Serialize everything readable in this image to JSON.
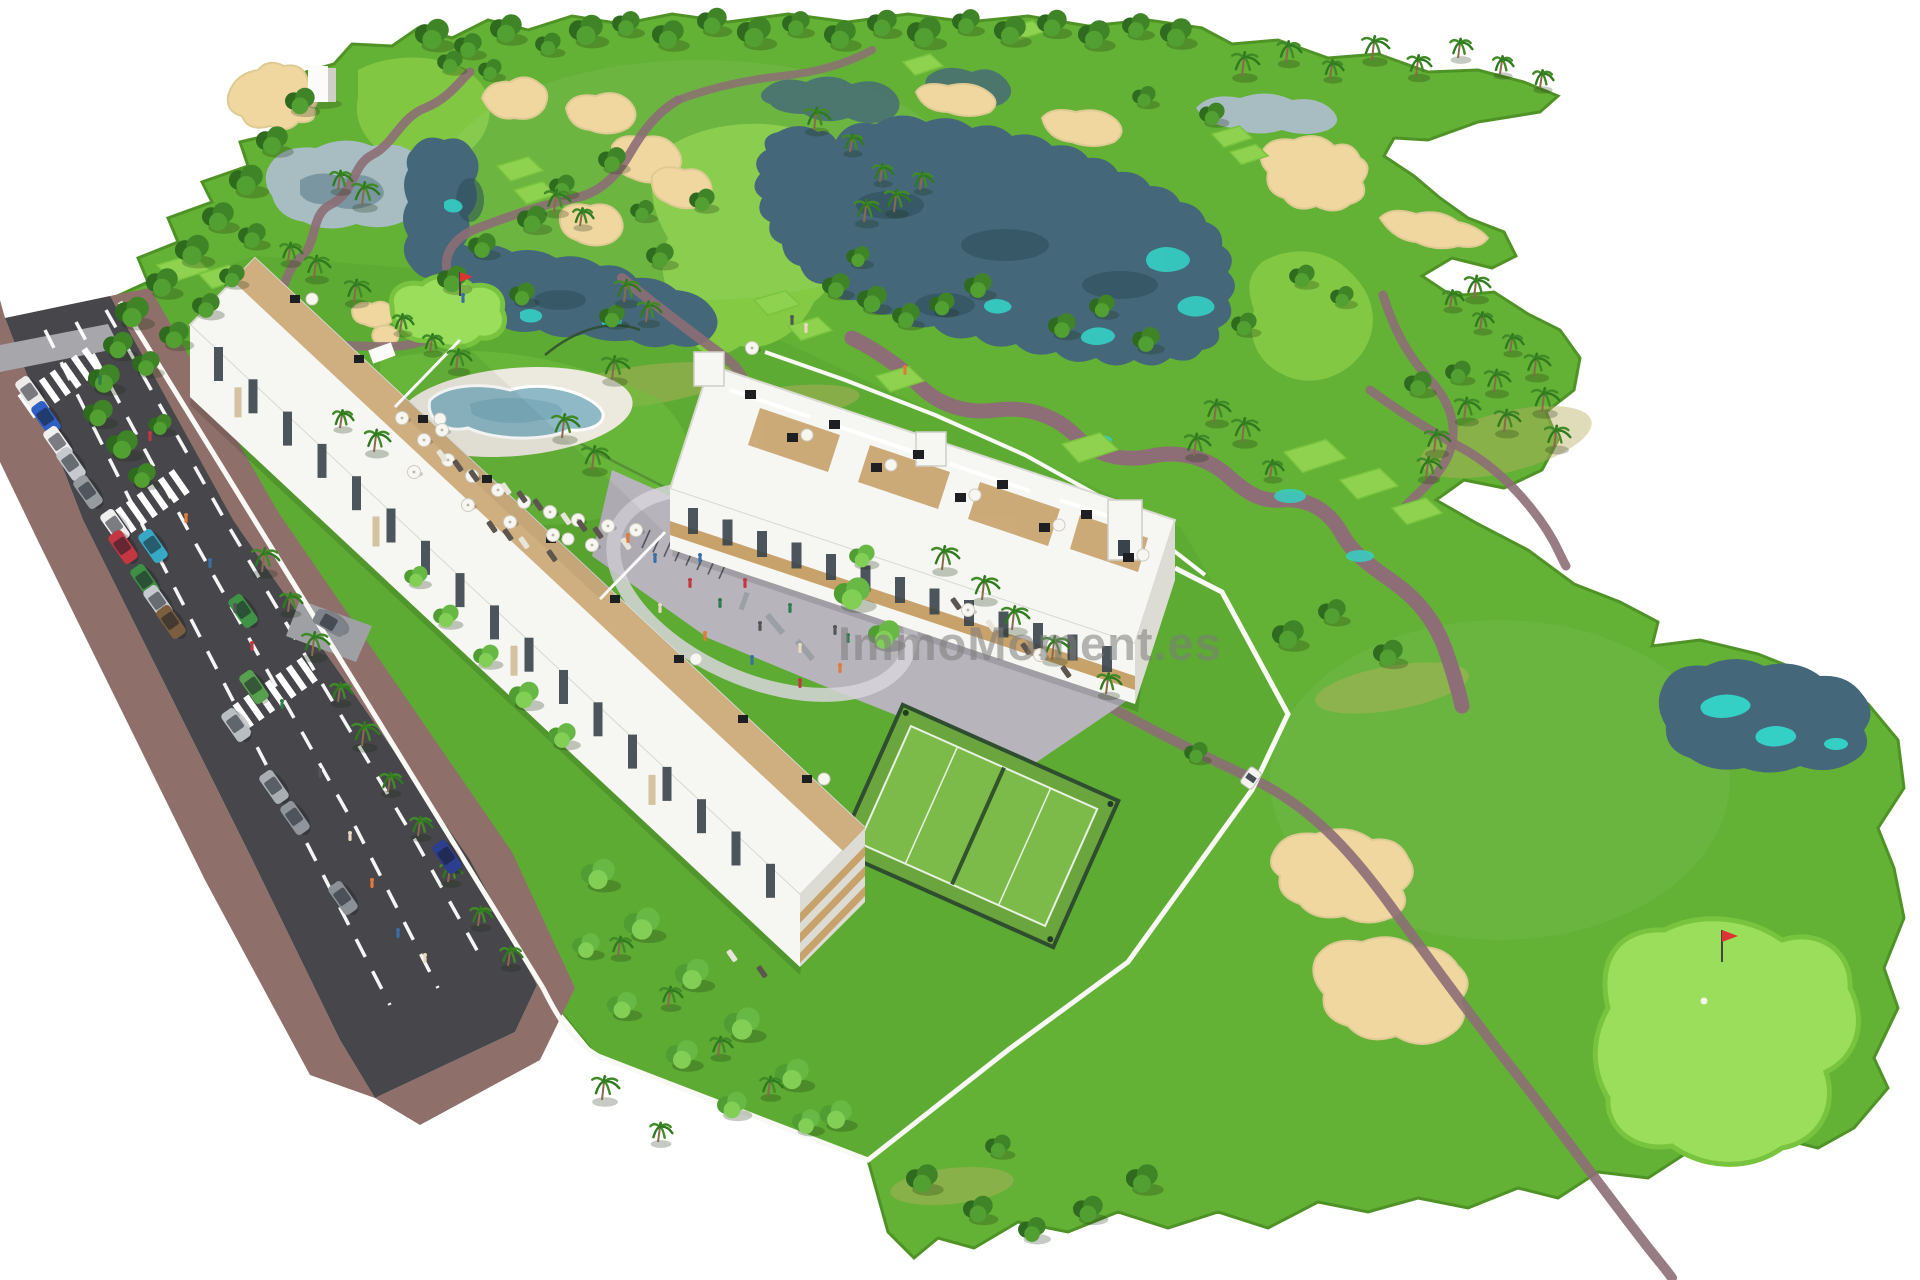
{
  "watermark": {
    "text": "ImmoMoment.es"
  },
  "palette": {
    "bg": "#ffffff",
    "grass": "#63b135",
    "grass2": "#5dab33",
    "grassLight": "#86cb44",
    "green": "#9ade5b",
    "greenFringe": "#79c43e",
    "tee": "#8fd24f",
    "sand": "#f0d7a0",
    "sandEdge": "#decb94",
    "water": "#44687a",
    "waterPale": "#a7bdc2",
    "waterAccent": "#35d0c5",
    "path": "#8d6e76",
    "road": "#46464b",
    "sidewalk": "#8f6f6a",
    "building": "#f6f6f2",
    "buildingShade": "#dddcd4",
    "wood": "#c8a26b",
    "glass": "#39444a",
    "wall": "#f8f8f4",
    "court": "#6aa63d",
    "watermark": "#7d7d7d"
  }
}
